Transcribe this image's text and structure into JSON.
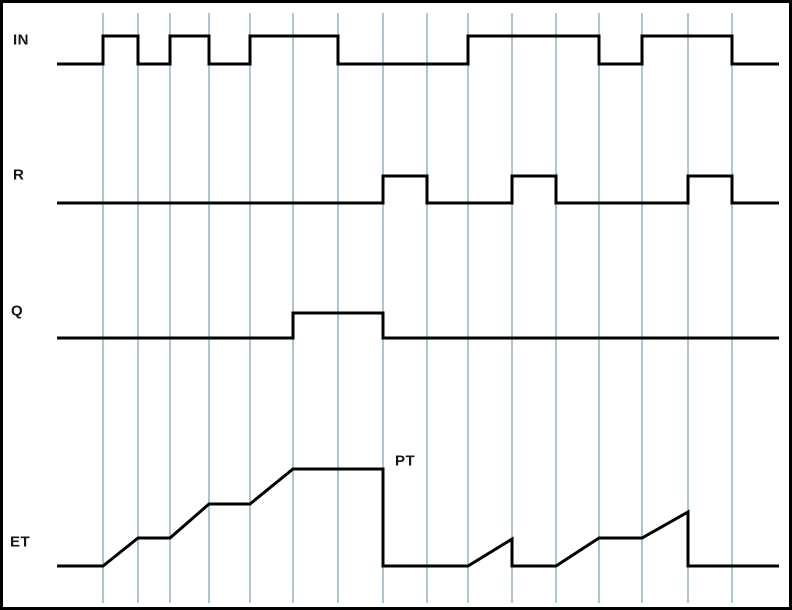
{
  "figure": {
    "colors": {
      "background": "#ffffff",
      "border": "#000000",
      "grid": "#aac6d1",
      "line": "#000000",
      "label": "#161616"
    },
    "size": {
      "width": 792,
      "height": 610
    },
    "gridlines": {
      "x": [
        103,
        138,
        170,
        209,
        250,
        293,
        338,
        383,
        427,
        468,
        512,
        556,
        599,
        642,
        688,
        732
      ],
      "top": 13,
      "bottom": 603
    },
    "labels": {
      "in": {
        "text": "IN",
        "x": 13,
        "y": 40
      },
      "r": {
        "text": "R",
        "x": 13,
        "y": 175
      },
      "q": {
        "text": "Q",
        "x": 11,
        "y": 311
      },
      "et": {
        "text": "ET",
        "x": 10,
        "y": 542
      },
      "pt": {
        "text": "PT",
        "x": 395,
        "y": 461
      }
    },
    "pt_level_y": 469,
    "signals": [
      {
        "name": "IN",
        "low_y": 64,
        "high_y": 36,
        "points": [
          [
            57,
            64
          ],
          [
            103,
            64
          ],
          [
            103,
            36
          ],
          [
            138,
            36
          ],
          [
            138,
            64
          ],
          [
            170,
            64
          ],
          [
            170,
            36
          ],
          [
            209,
            36
          ],
          [
            209,
            64
          ],
          [
            250,
            64
          ],
          [
            250,
            36
          ],
          [
            338,
            36
          ],
          [
            338,
            64
          ],
          [
            468,
            64
          ],
          [
            468,
            36
          ],
          [
            599,
            36
          ],
          [
            599,
            64
          ],
          [
            642,
            64
          ],
          [
            642,
            36
          ],
          [
            732,
            36
          ],
          [
            732,
            64
          ],
          [
            779,
            64
          ]
        ]
      },
      {
        "name": "R",
        "low_y": 203,
        "high_y": 176,
        "points": [
          [
            57,
            203
          ],
          [
            383,
            203
          ],
          [
            383,
            176
          ],
          [
            427,
            176
          ],
          [
            427,
            203
          ],
          [
            512,
            203
          ],
          [
            512,
            176
          ],
          [
            556,
            176
          ],
          [
            556,
            203
          ],
          [
            688,
            203
          ],
          [
            688,
            176
          ],
          [
            732,
            176
          ],
          [
            732,
            203
          ],
          [
            779,
            203
          ]
        ]
      },
      {
        "name": "Q",
        "low_y": 338,
        "high_y": 313,
        "points": [
          [
            57,
            338
          ],
          [
            293,
            338
          ],
          [
            293,
            313
          ],
          [
            383,
            313
          ],
          [
            383,
            338
          ],
          [
            779,
            338
          ]
        ]
      },
      {
        "name": "ET",
        "low_y": 566,
        "high_y": 469,
        "points": [
          [
            57,
            566
          ],
          [
            103,
            566
          ],
          [
            138,
            538
          ],
          [
            170,
            538
          ],
          [
            209,
            504
          ],
          [
            250,
            504
          ],
          [
            293,
            469
          ],
          [
            383,
            469
          ],
          [
            383,
            566
          ],
          [
            468,
            566
          ],
          [
            512,
            539
          ],
          [
            512,
            566
          ],
          [
            556,
            566
          ],
          [
            599,
            538
          ],
          [
            642,
            538
          ],
          [
            688,
            512
          ],
          [
            688,
            566
          ],
          [
            779,
            566
          ]
        ]
      }
    ]
  }
}
